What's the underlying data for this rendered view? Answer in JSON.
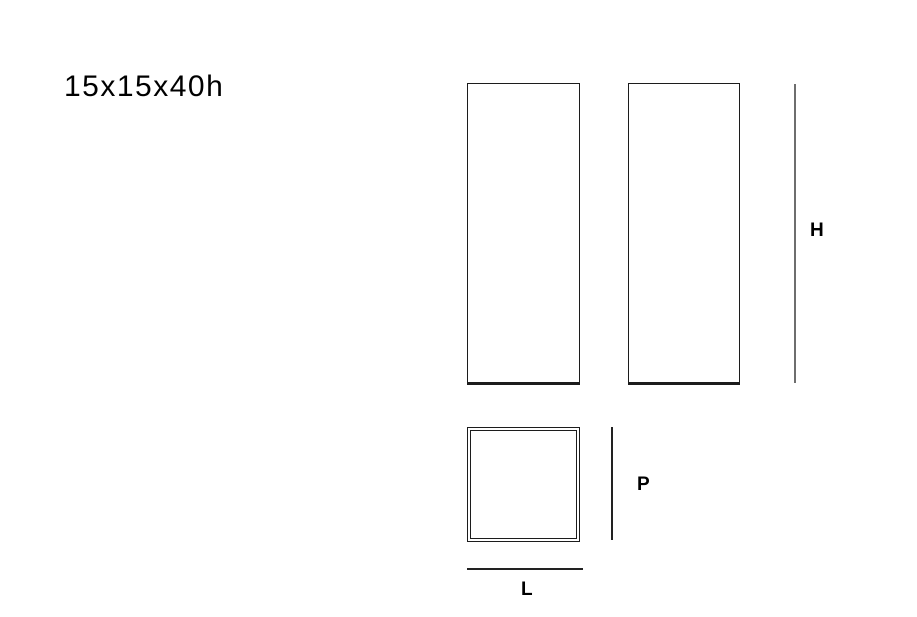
{
  "title": "15x15x40h",
  "dimensions": {
    "height": {
      "label": "H"
    },
    "depth": {
      "label": "P"
    },
    "length": {
      "label": "L"
    }
  },
  "colors": {
    "background": "#ffffff",
    "outline": "#1c1c1c",
    "dimension_line": "#222222",
    "dimension_line_light": "#6e6e6e",
    "text": "#000000"
  }
}
